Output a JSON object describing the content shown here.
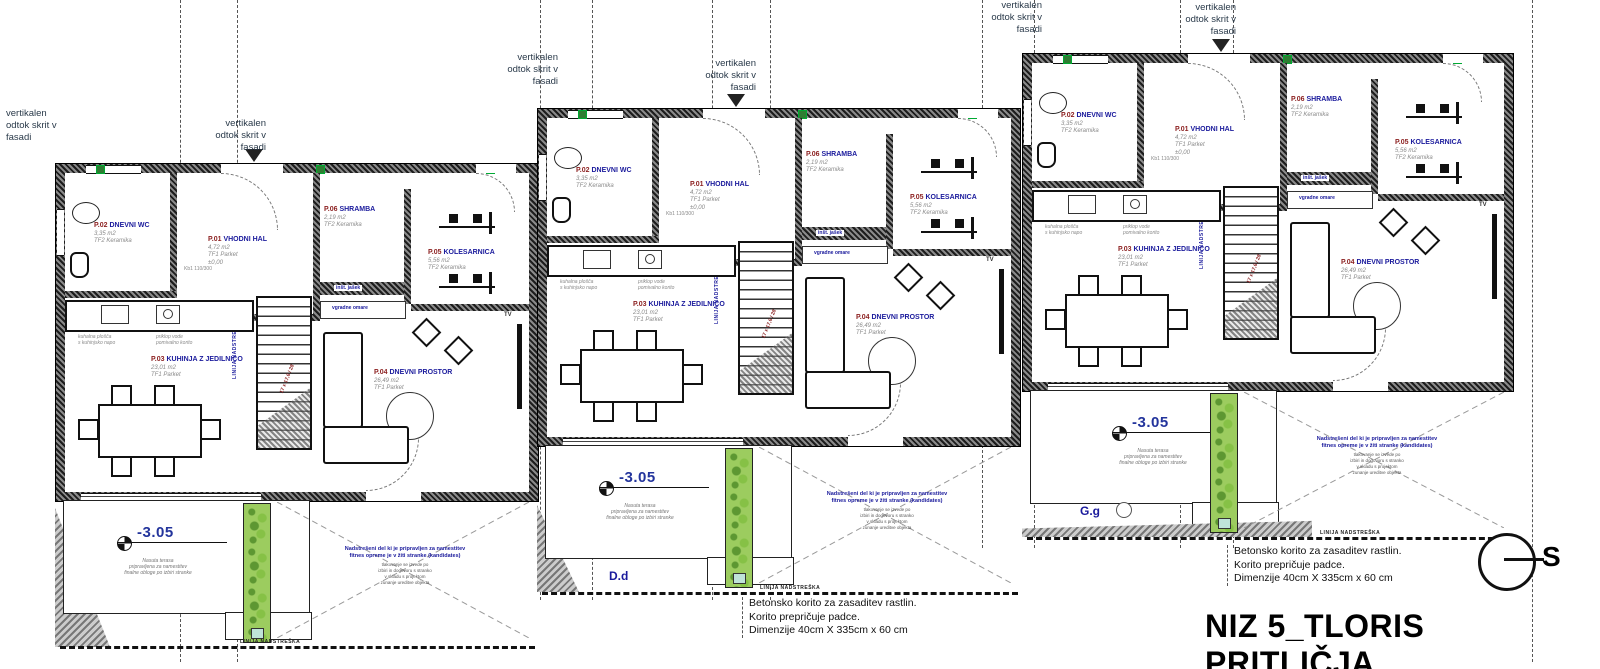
{
  "title": "NIZ 5_TLORIS PRITLIČJA",
  "north": {
    "label": "S"
  },
  "annotations": {
    "vertical_drain": "vertikalen\nodtok skrit v\nfasadi",
    "planter_note": "Betonsko korito za zasaditev rastlin.\nKorito prepričuje padce.\nDimenzije 40cm X 335cm x 60 cm",
    "terrace_note_blue": "Nadstrešeni del ki je pripravljen za namestitev\nfitnes opreme je v žiti stranke (kandidates)",
    "terrace_note_gray": "tlakovanje se izvede po\nizbiri in dogovoru s stranko\nv skladu s projektom\nzunanje ureditve objekta",
    "level_note": "Nasuta terasa\npripravljena za namestitev\nfinalne obloge po izbiri stranke",
    "window_mark": "Kb1  110/300",
    "stair_note": "17 x 17,6 / 28",
    "canopy_line": "LINIJA NADSTREŠKA",
    "kitchen_hob": "kuhalna plošča\ns kuhinjsko napo",
    "kitchen_sink": "priklop vode\npomivalno korito"
  },
  "levels": {
    "terrace": "-3.05"
  },
  "sections": {
    "d": "D.d",
    "g": "G.g"
  },
  "labels": {
    "shaft": "inšt. jašek",
    "wardrobe": "vgradne omare",
    "tv": "TV"
  },
  "rooms": {
    "p01": {
      "code": "P.01",
      "name": "VHODNI HAL",
      "area": "4,72 m2",
      "floor": "TF1 Parket",
      "level": "±0,00"
    },
    "p02": {
      "code": "P.02",
      "name": "DNEVNI WC",
      "area": "3,35 m2",
      "floor": "TF2 Keramika",
      "level": "-1,80"
    },
    "p03": {
      "code": "P.03",
      "name": "KUHINJA Z JEDILNICO",
      "area": "23,01 m2",
      "floor": "TF1 Parket"
    },
    "p04": {
      "code": "P.04",
      "name": "DNEVNI PROSTOR",
      "area": "26,49 m2",
      "floor": "TF1 Parket"
    },
    "p05": {
      "code": "P.05",
      "name": "KOLESARNICA",
      "area": "5,56 m2",
      "floor": "TF2 Keramika"
    },
    "p06": {
      "code": "P.06",
      "name": "SHRAMBA",
      "area": "2,19 m2",
      "floor": "TF2 Keramika",
      "level": "±0,00"
    }
  }
}
